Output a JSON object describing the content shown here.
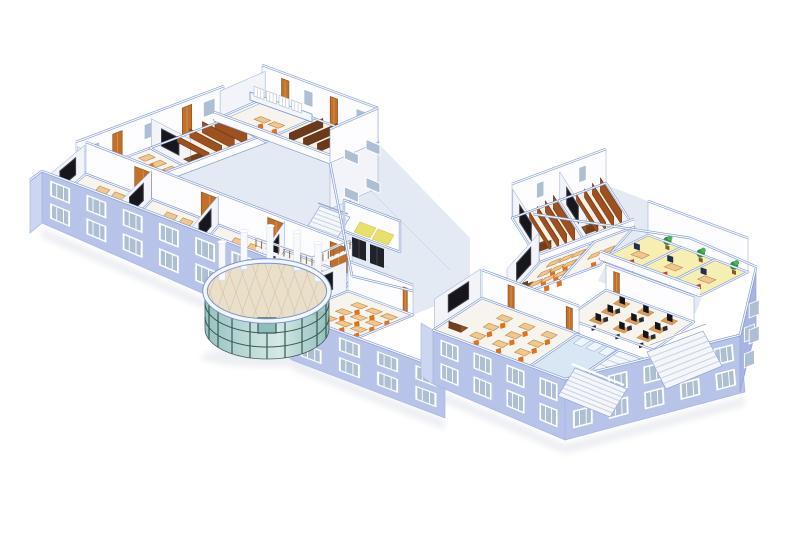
{
  "title": "3D isometric cutaway rendering of a school building floor plan",
  "background": "#ffffff",
  "palette": {
    "bg": "#ffffff",
    "facade": "#b7c3e8",
    "facadeLight": "#cdd6f1",
    "facadeDark": "#a8b5e0",
    "wallFace": "#fdfdff",
    "wallShade": "#f2f4fa",
    "capFill": "#f3f6fd",
    "capEdge": "#7b94cc",
    "roomLine": "#8fa6d4",
    "corridorFloor": "#e4eaf4",
    "tileLine": "#cdd8e9",
    "roomFloor": "#f7f4ed",
    "roomFloorWarm": "#f9f2e4",
    "windowFrame": "#ffffff",
    "windowGlass": "#aebfd4",
    "deskTop": "#f1c78e",
    "deskEdge": "#b9894d",
    "chairOrange": "#e47019",
    "teacherDesk": "#6f3f1e",
    "teacherTop": "#8c5628",
    "blackboard": "#16161c",
    "blackboardFrame": "#40404a",
    "tierBrown": "#9d5120",
    "tierFace": "#7c3d12",
    "shelfBrown": "#6c3a1b",
    "doorOrange": "#c0702a",
    "doorLight": "#da9040",
    "glassTeal": "#b9d9d5",
    "glassTealDeep": "#8fbeba",
    "mullion": "#3a5956",
    "rotundaFloor": "#eadfc8",
    "rotundaTile": "#d7caac",
    "column": "#f7f9fc",
    "columnShade": "#d8dfeb",
    "labTable": "#dc9c5a",
    "monitor": "#14141b",
    "chairBlack": "#2b2b30",
    "officeFloor": "#f7efb2",
    "chairRed": "#d23a26",
    "plant": "#2f9039",
    "plantLight": "#4cb456",
    "pot": "#8a5529",
    "washFloor": "#d8e7f3",
    "stall": "#eef5fb",
    "stair": "#f4f6fa",
    "stairEdge": "#c8d2e4",
    "railing": "#98a7c6",
    "railWood": "#8a6a4a",
    "elevatorDoor": "#22222a",
    "elevatorTile": "#e9e06b",
    "shadow": "#dfe2e9"
  },
  "scene": {
    "view": "isometric-cutaway",
    "floors_below_cutaway": 2,
    "left_wing": {
      "front_classrooms": [
        {
          "name": "classroom-1",
          "type": "classroom"
        },
        {
          "name": "classroom-2",
          "type": "classroom"
        },
        {
          "name": "classroom-3",
          "type": "classroom"
        },
        {
          "name": "classroom-4",
          "type": "classroom"
        }
      ],
      "back_bar_west": [
        {
          "name": "classroom-5",
          "type": "classroom"
        },
        {
          "name": "lecture-hall-1",
          "type": "lecture-hall",
          "tier_rows": 4
        }
      ],
      "back_bar_east": [
        {
          "name": "office-1",
          "type": "office"
        },
        {
          "name": "seminar-room",
          "type": "seminar-room",
          "shelf_rows": 3
        }
      ]
    },
    "junction": {
      "staircase": true,
      "elevator_doors": 2,
      "elevator_floor_tiles": "yellow",
      "balustrade": true,
      "classroom": {
        "name": "classroom-6",
        "type": "classroom"
      }
    },
    "rotunda": {
      "type": "glass-atrium",
      "columns": 5,
      "glass_mullions": 8,
      "floor": "beige-tile"
    },
    "right_wing": {
      "lecture_halls": [
        {
          "name": "lecture-hall-2",
          "tier_rows": 4
        },
        {
          "name": "lecture-hall-3",
          "tier_rows": 4
        }
      ],
      "mid_rooms": [
        {
          "name": "classroom-7",
          "type": "classroom"
        },
        {
          "name": "office-2",
          "type": "office"
        }
      ],
      "yellow_offices": [
        {
          "name": "office-3",
          "plant": true,
          "red_chair": true
        },
        {
          "name": "office-4",
          "plant": true,
          "red_chair": true
        },
        {
          "name": "office-5",
          "plant": true,
          "red_chair": true
        }
      ],
      "computer_lab": {
        "name": "computer-lab",
        "workstations": 9
      },
      "large_classroom": {
        "name": "classroom-8"
      },
      "washroom": {
        "name": "washroom"
      },
      "exterior_staircase": true,
      "entrance_steps": true
    },
    "facade_window_rows": 2
  }
}
